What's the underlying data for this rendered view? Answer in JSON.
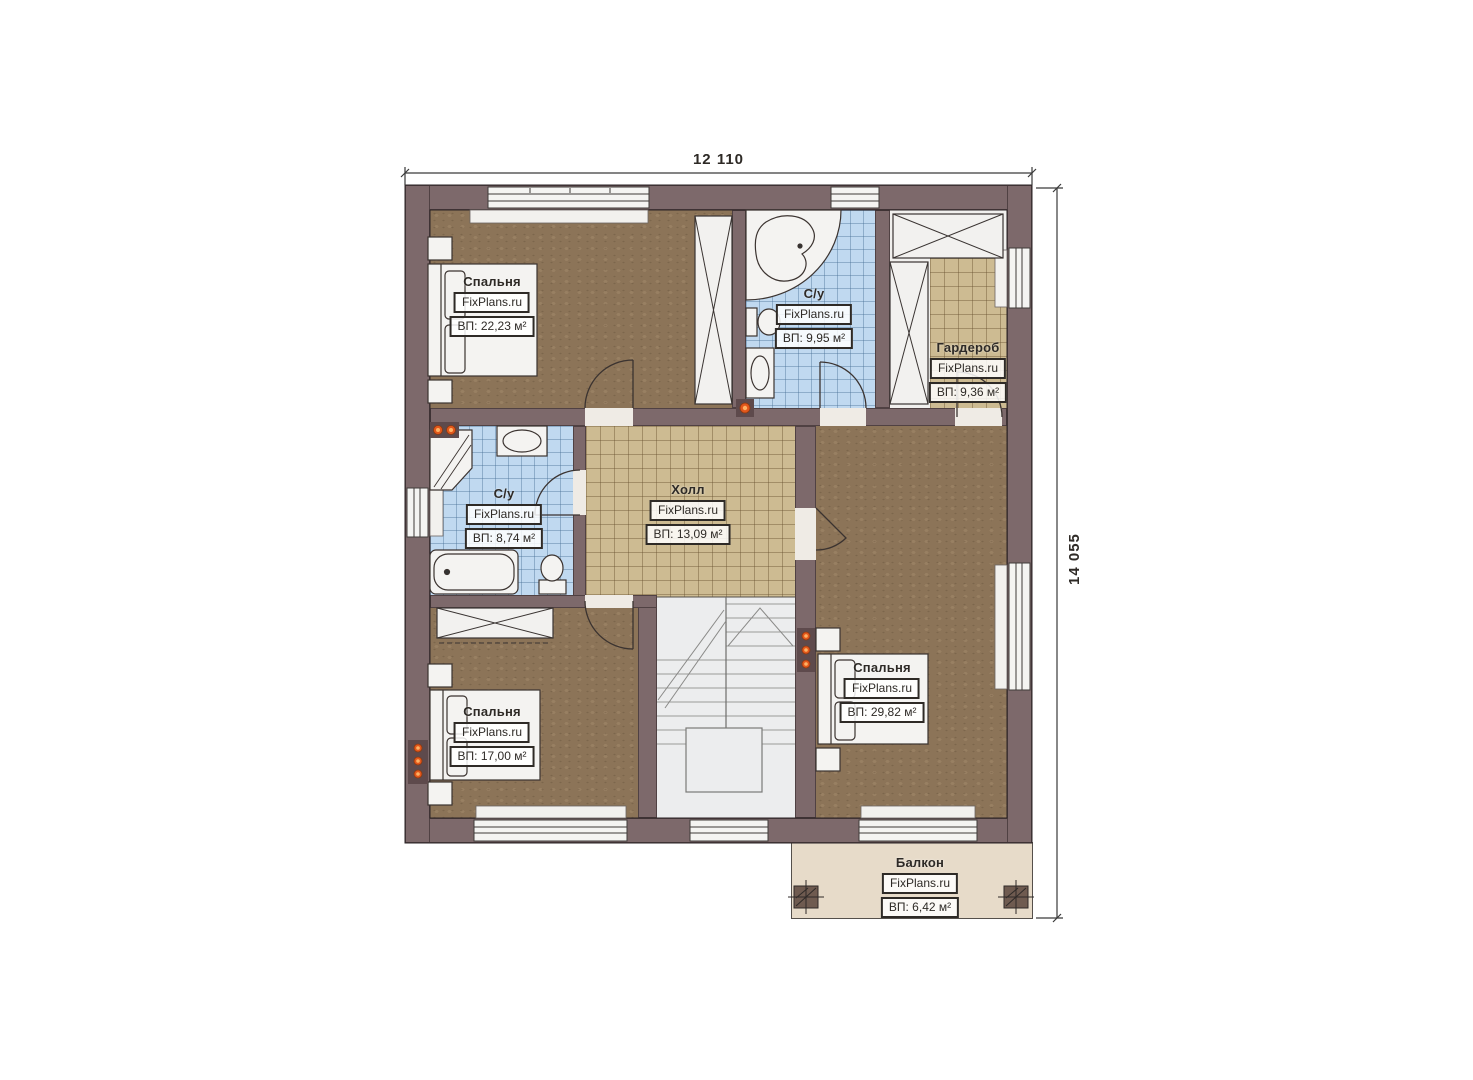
{
  "watermark": "FixPlans.ru",
  "dimensions": {
    "width_label": "12 110",
    "height_label": "14 055"
  },
  "rooms": [
    {
      "id": "bedroom-top-left",
      "name": "Спальня",
      "brand": "FixPlans.ru",
      "area": "ВП: 22,23 м²"
    },
    {
      "id": "bathroom-top",
      "name": "С/у",
      "brand": "FixPlans.ru",
      "area": "ВП: 9,95 м²"
    },
    {
      "id": "wardrobe",
      "name": "Гардероб",
      "brand": "FixPlans.ru",
      "area": "ВП: 9,36 м²"
    },
    {
      "id": "bathroom-left",
      "name": "С/у",
      "brand": "FixPlans.ru",
      "area": "ВП: 8,74 м²"
    },
    {
      "id": "hall",
      "name": "Холл",
      "brand": "FixPlans.ru",
      "area": "ВП: 13,09 м²"
    },
    {
      "id": "bedroom-bottom-left",
      "name": "Спальня",
      "brand": "FixPlans.ru",
      "area": "ВП: 17,00 м²"
    },
    {
      "id": "bedroom-right",
      "name": "Спальня",
      "brand": "FixPlans.ru",
      "area": "ВП: 29,82 м²"
    },
    {
      "id": "balcony",
      "name": "Балкон",
      "brand": "FixPlans.ru",
      "area": "ВП: 6,42 м²"
    }
  ],
  "colors": {
    "wall": "#7d696b",
    "wood_floor": "#8c7458",
    "tile_blue": "#c0d9f0",
    "tile_tan": "#cdbb92",
    "balcony_floor": "#e7dbc9",
    "stairs": "#ecedee",
    "fixture_white": "#f4f3f1",
    "socket_dot": "#e2571b"
  }
}
